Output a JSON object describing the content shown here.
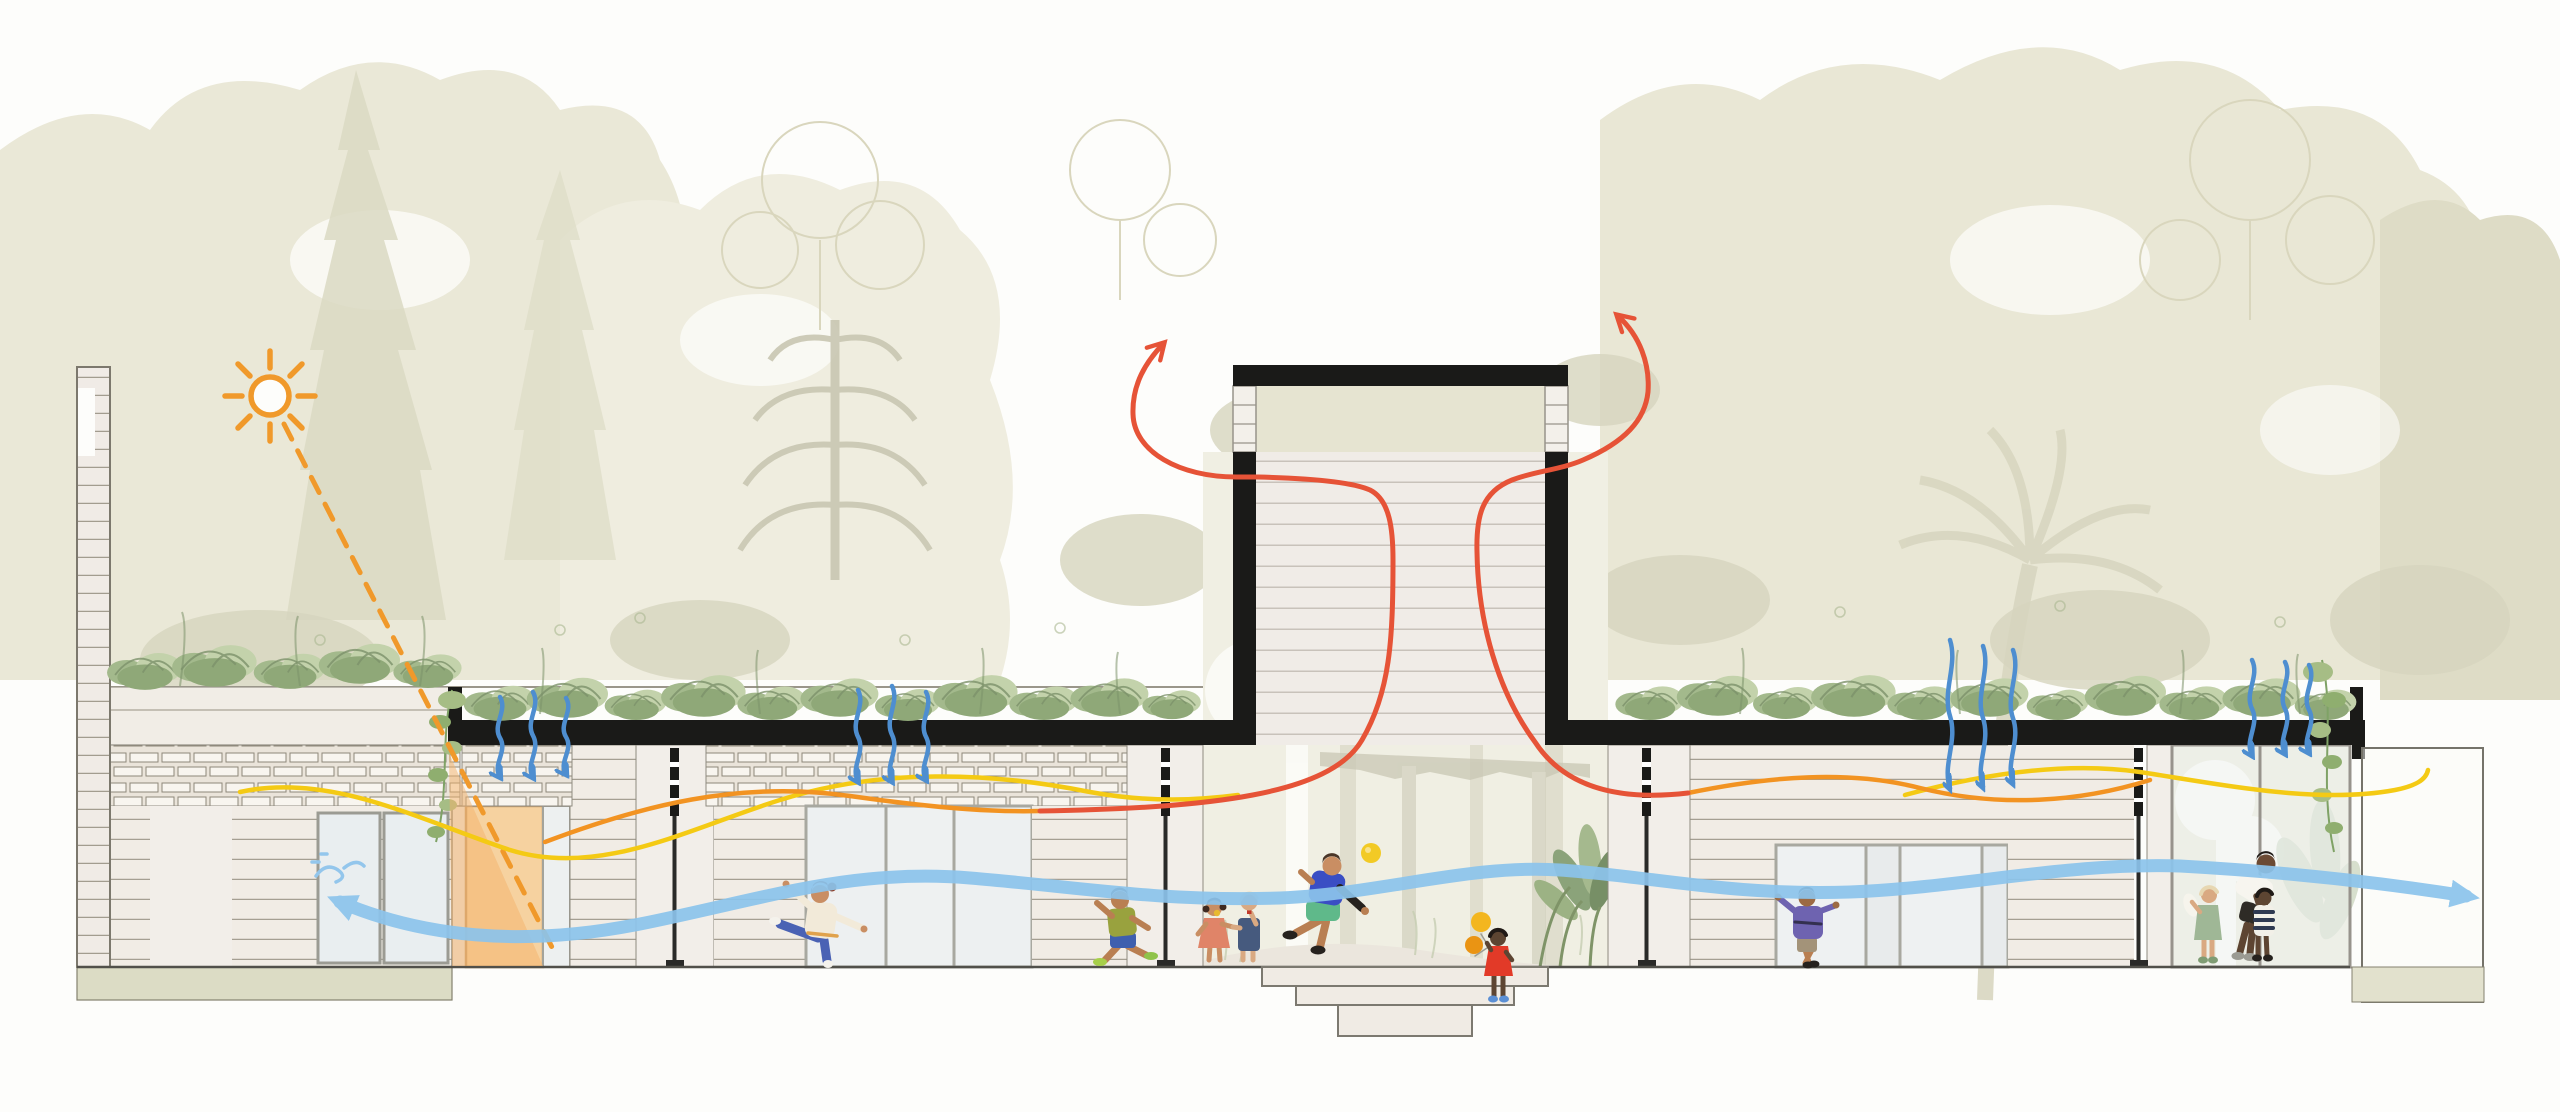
{
  "meta": {
    "title": "Architectural section diagram — kindergarten pavilion with passive climate strategies",
    "diagram_type": "building-section environmental diagram",
    "visible_text": []
  },
  "palette": {
    "sun_orange": "#f0992b",
    "sun_patch_peach": "#f4b269",
    "hot_air_red": "#e65337",
    "warm_air_orange": "#f29322",
    "warm_air_yellow": "#f4ca14",
    "breeze_blue": "#8cc4ec",
    "rain_blue": "#4e8ed0",
    "structure_black": "#1a1a18",
    "foliage_green": "#8fa878",
    "background_olive": "#e7e5d3",
    "door_peach": "#f6d2a0"
  },
  "annotations": {
    "sun_icon": "orange line sun symbol, upper left",
    "solar_ray": "orange dashed ray from sun to doorway",
    "solar_gain_patch": "translucent peach triangle of sunlight on door",
    "stack_ventilation_arrows": [
      "red curved arrow rising out of chimney to the left",
      "red curved arrow rising out of chimney to the right"
    ],
    "warm_air_lines": [
      "orange wavy line at ceiling level",
      "yellow wavy line at ceiling level"
    ],
    "cross_breeze_line": "thick light-blue wavy line spanning section, arrowheads at both ends",
    "rain_infiltration_groups": 5,
    "rain_arrows_per_group": 3,
    "breeze_swirl_icon": "small blue wind swirl at left window"
  },
  "scene": {
    "buildings": [
      {
        "id": "left-annex",
        "desc": "neighbouring wall with roof terrace shrubs, brick band, two windows"
      },
      {
        "id": "left-pavilion",
        "desc": "green-roof pavilion: peach door, marble piers, plank walls, sliding glazing"
      },
      {
        "id": "ventilation-tower",
        "desc": "central black chimney with louvre band and stone shaft"
      },
      {
        "id": "right-pavilion",
        "desc": "green-roof pavilion: plank walls, sliding doors, end glazing and garden wall"
      }
    ],
    "courtyard": {
      "steps": 3,
      "desc": "sunken stepped threshold below central chimney"
    },
    "figures": [
      {
        "id": "dancing-girl",
        "desc": "child balancing on one leg, white top, blue pants"
      },
      {
        "id": "running-boy",
        "desc": "boy running left, olive tee, blue shorts, lime shoes"
      },
      {
        "id": "girl-salmon",
        "desc": "girl in salmon dress with popsicle, holding hands"
      },
      {
        "id": "kid-overalls",
        "desc": "toddler in denim overalls with red popsicle"
      },
      {
        "id": "boy-kicking-ball",
        "desc": "boy in blue shirt and mint shorts heading a yellow ball"
      },
      {
        "id": "toddler-balloons",
        "desc": "toddler in red dress with two yellow balloons on the steps"
      },
      {
        "id": "kid-doorway",
        "desc": "child in purple sweater stretching across sliding door"
      },
      {
        "id": "adult-with-children",
        "desc": "adult in white tee and black shorts helping a toddler in striped shirt, girl in sage dress beside"
      }
    ],
    "background": "pale olive tropical tree silhouettes, palm and line-drawn canopies"
  }
}
